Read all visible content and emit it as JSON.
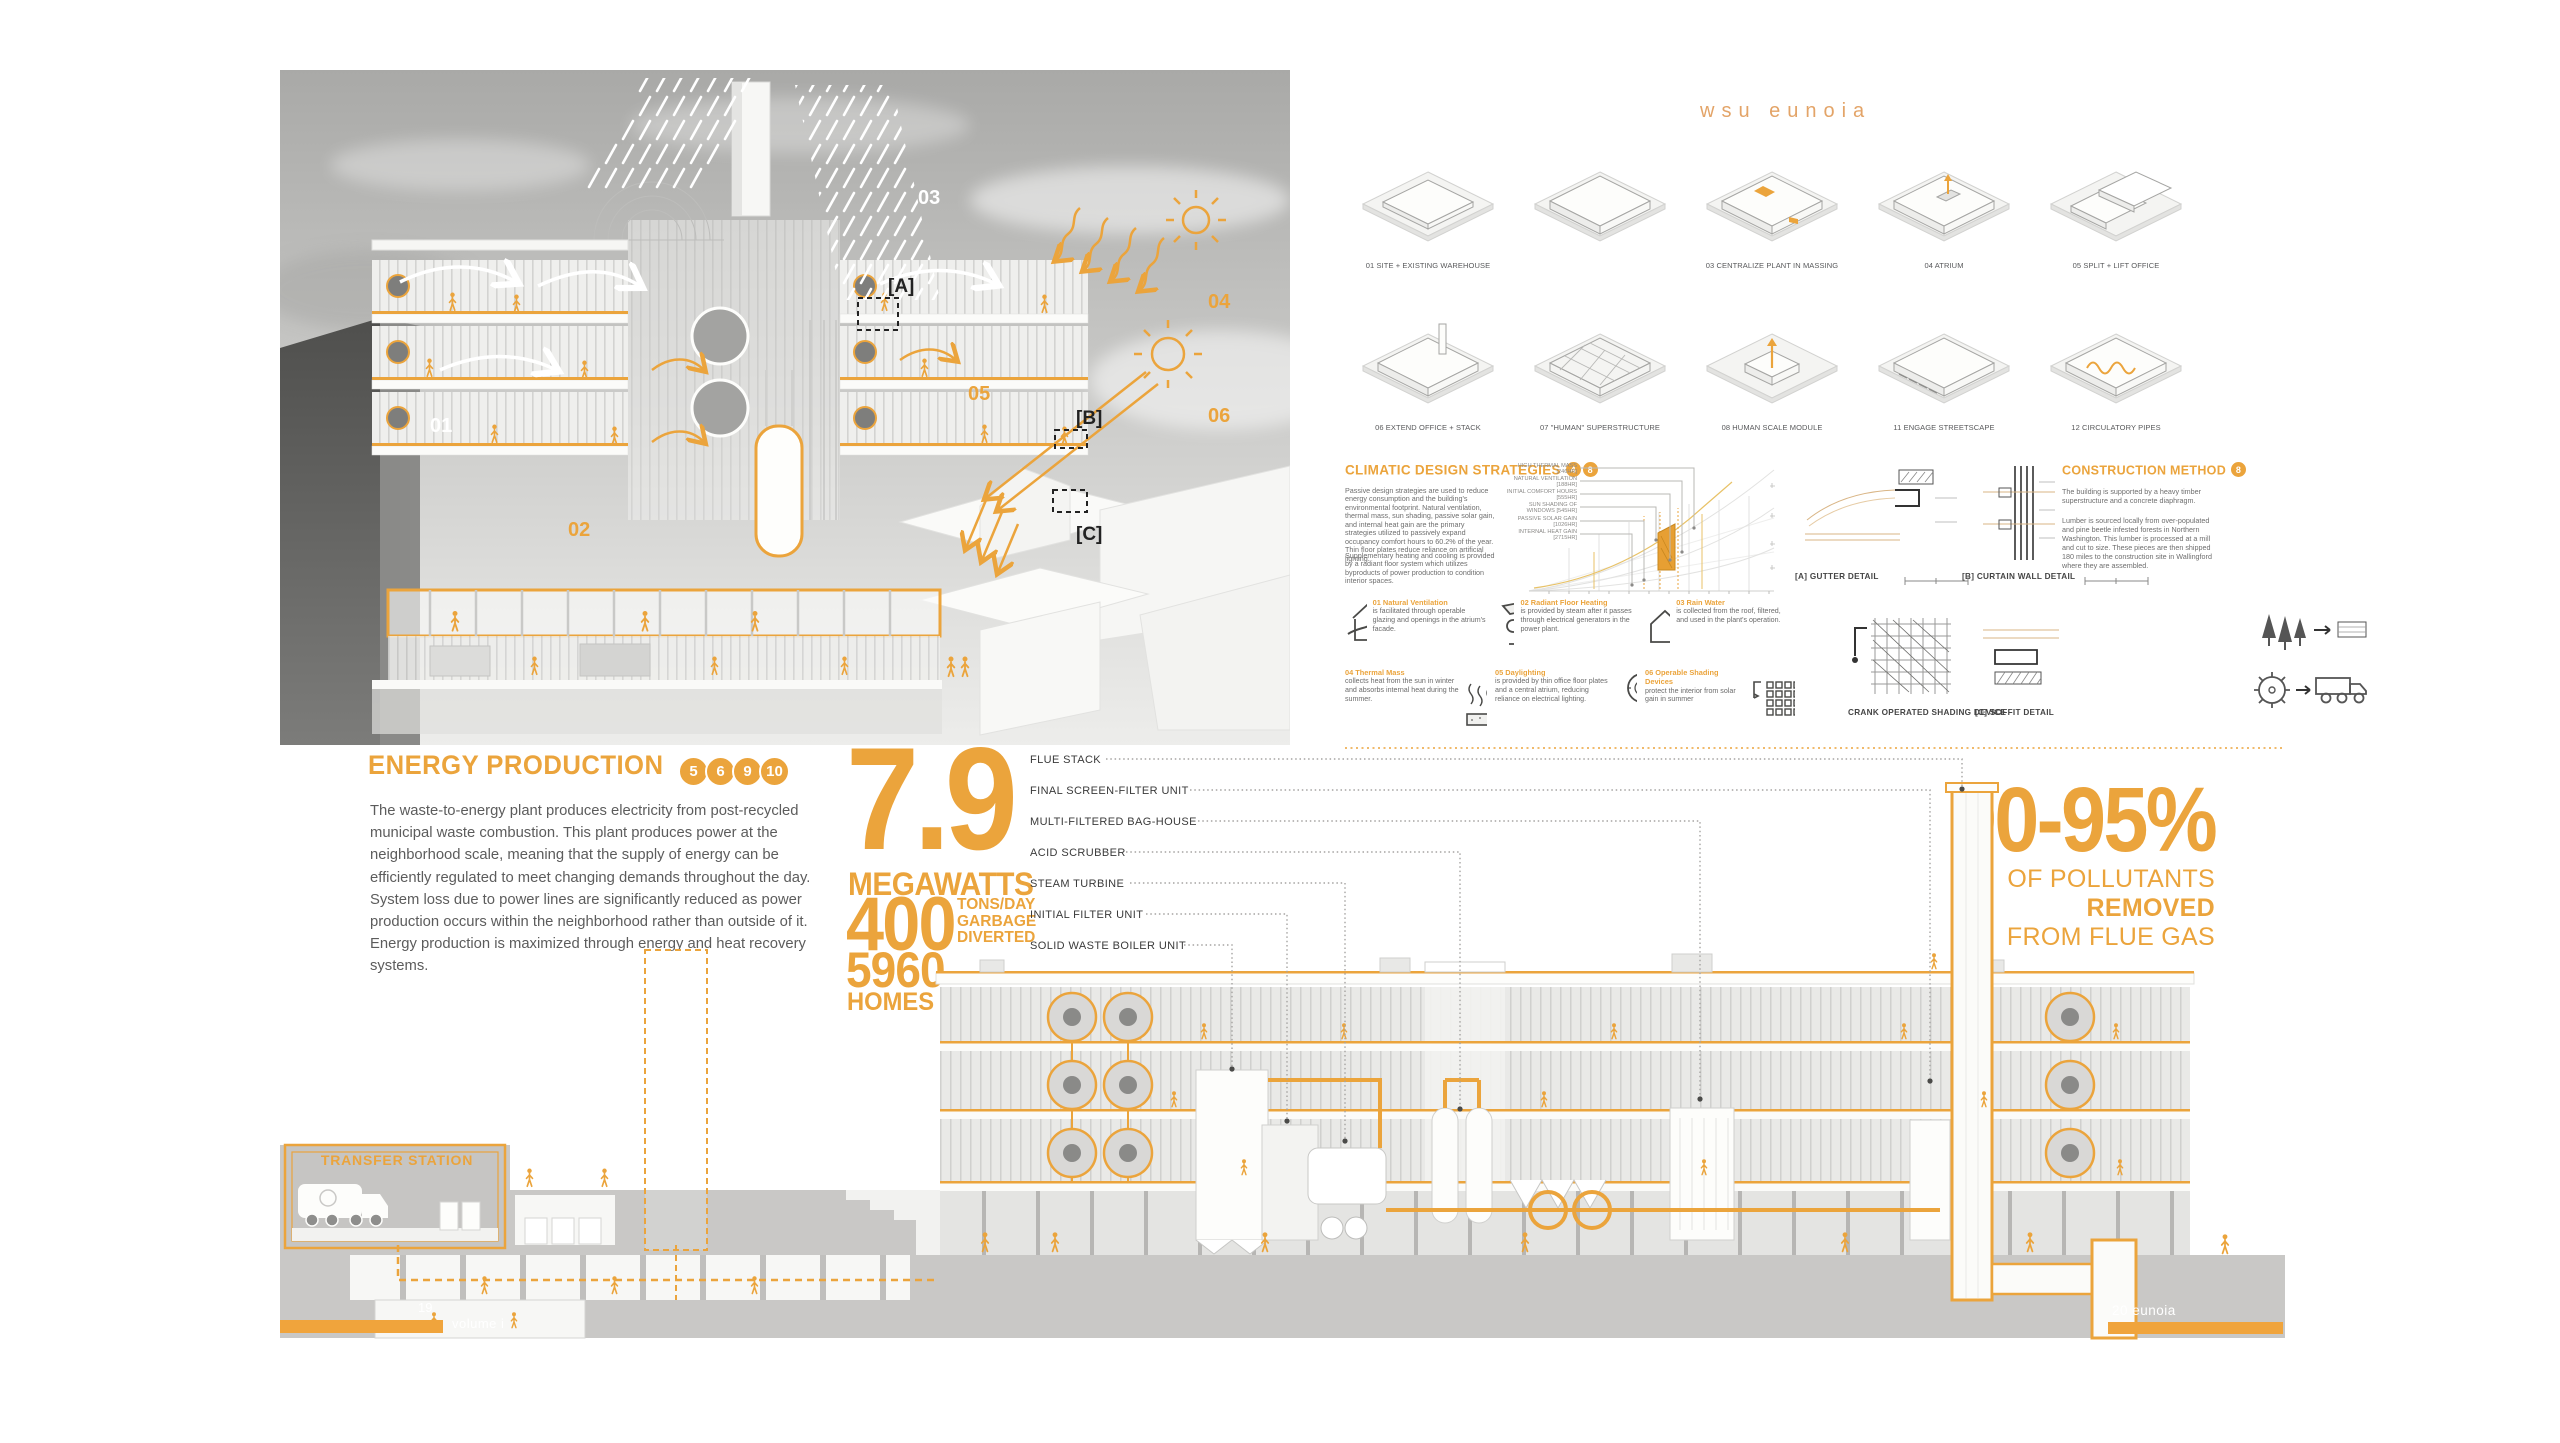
{
  "title": "wsu eunoia",
  "colors": {
    "accent": "#EBA43C",
    "accent_deep": "#E79F33",
    "title_orange": "#E3A468",
    "ground_gray": "#C9C8C6"
  },
  "hero": {
    "callouts": {
      "n01": "01",
      "n02": "02",
      "n03": "03",
      "n04": "04",
      "n05": "05",
      "n06": "06",
      "a": "[A]",
      "b": "[B]",
      "c": "[C]"
    }
  },
  "massing": {
    "row1": [
      {
        "label": "01 SITE + EXISTING WAREHOUSE"
      },
      {
        "label": ""
      },
      {
        "label": "03 CENTRALIZE PLANT IN MASSING"
      },
      {
        "label": "04 ATRIUM"
      },
      {
        "label": "05 SPLIT + LIFT OFFICE"
      }
    ],
    "row2": [
      {
        "label": "06 EXTEND OFFICE + STACK"
      },
      {
        "label": "07 \"HUMAN\" SUPERSTRUCTURE"
      },
      {
        "label": "08 HUMAN SCALE MODULE"
      },
      {
        "label": "11 ENGAGE STREETSCAPE"
      },
      {
        "label": "12 CIRCULATORY PIPES"
      }
    ]
  },
  "climatic": {
    "heading": "CLIMATIC DESIGN STRATEGIES",
    "badges": [
      "4",
      "8"
    ],
    "para1": "Passive design strategies are used to reduce energy consumption and the building's environmental footprint. Natural ventilation, thermal mass, sun shading, passive solar gain, and internal heat gain are the primary strategies utilized to passively expand occupancy comfort hours to 60.2% of the year. Thin floor plates reduce reliance on artificial lighting.",
    "para2": "Supplementary heating and cooling is provided by a radiant floor system which utilizes byproducts of power production to condition interior spaces.",
    "chart_labels": [
      "HIGH THERMAL MASS [246HR]",
      "NATURAL VENTILATION [188HR]",
      "INITIAL COMFORT HOURS [555HR]",
      "SUN SHADING OF WINDOWS [545HR]",
      "PASSIVE SOLAR GAIN [1026HR]",
      "INTERNAL HEAT GAIN [2715HR]"
    ]
  },
  "strategies": [
    {
      "t": "01 Natural Ventilation",
      "d": "is facilitated through operable glazing and openings in the atrium's facade."
    },
    {
      "t": "02 Radiant Floor Heating",
      "d": "is provided by steam after it passes through electrical generators in the power plant."
    },
    {
      "t": "03 Rain Water",
      "d": "is collected from the roof, filtered, and used in the plant's operation."
    },
    {
      "t": "04 Thermal Mass",
      "d": "collects heat from the sun in winter and absorbs internal heat during the summer."
    },
    {
      "t": "05 Daylighting",
      "d": "is provided by thin office floor plates and a central atrium, reducing reliance on electrical lighting."
    },
    {
      "t": "06 Operable Shading Devices",
      "d": "protect the interior from solar gain in summer"
    }
  ],
  "details": {
    "a": "[A] GUTTER DETAIL",
    "b": "[B] CURTAIN WALL DETAIL",
    "crank": "CRANK OPERATED SHADING DEVICE",
    "c": "[C] SOFFIT DETAIL"
  },
  "construction": {
    "heading": "CONSTRUCTION METHOD",
    "badge": "8",
    "para1": "The building is supported by a heavy timber superstructure and a concrete diaphragm.",
    "para2": "Lumber is sourced locally from over-populated and pine beetle infested forests in Northern Washington. This lumber is processed at a mill and cut to size. These pieces are then shipped 180 miles to the construction site in Wallingford where they are assembled."
  },
  "energy": {
    "heading": "ENERGY PRODUCTION",
    "badges": [
      "5",
      "6",
      "9",
      "10"
    ],
    "para": "The waste-to-energy plant produces electricity from post-recycled municipal waste combustion. This plant produces power at the neighborhood scale, meaning that the supply of energy can be efficiently regulated to meet changing demands throughout the day. System loss due to power lines are significantly reduced as power production occurs within the neighborhood rather than outside of it. Energy production is maximized through energy and heat recovery systems."
  },
  "stats": {
    "megawatts": "7.9",
    "megawatts_label": "MEGAWATTS",
    "tons": "400",
    "tons_lines": [
      "TONS/DAY",
      "GARBAGE",
      "DIVERTED"
    ],
    "homes": "5960",
    "homes_label": "HOMES"
  },
  "flue_labels": [
    "FLUE STACK",
    "FINAL SCREEN-FILTER UNIT",
    "MULTI-FILTERED BAG-HOUSE",
    "ACID SCRUBBER",
    "STEAM TURBINE",
    "INITIAL FILTER UNIT",
    "SOLID WASTE BOILER UNIT"
  ],
  "pollutants": {
    "value": "90-95%",
    "line1a": "OF POLLUTANTS ",
    "line1b": "REMOVED",
    "line2": "FROM FLUE GAS"
  },
  "transfer_station": "TRANSFER STATION",
  "footer": {
    "left_num": "19",
    "left_label": "volume i",
    "right": "20 eunoia"
  }
}
